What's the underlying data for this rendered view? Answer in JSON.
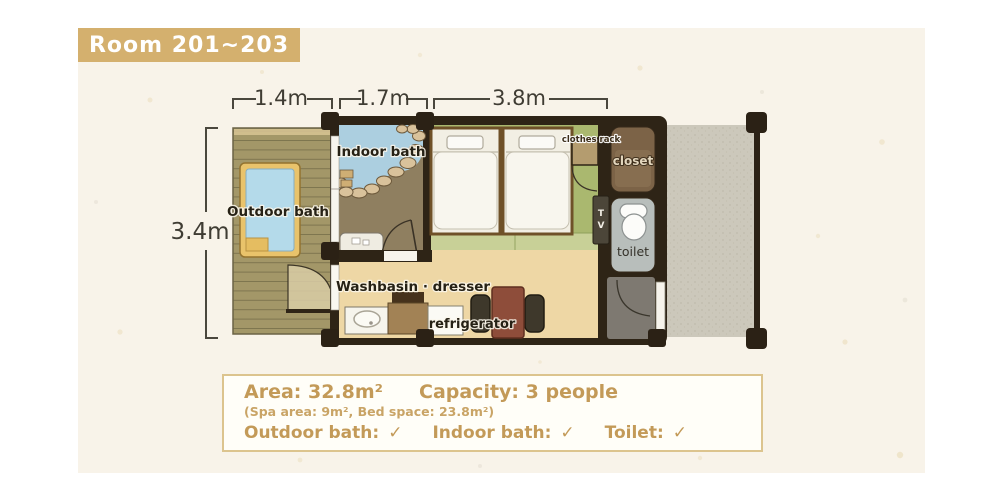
{
  "banner": {
    "title": "Room 201~203",
    "bg_color": "#d4b06e"
  },
  "dimensions": {
    "width_left": "1.4m",
    "width_middle": "1.7m",
    "width_right": "3.8m",
    "height_left": "3.4m"
  },
  "plan": {
    "labels": {
      "outdoor_bath": "Outdoor bath",
      "indoor_bath": "Indoor bath",
      "clothes_rack": "clothes rack",
      "closet": "closet",
      "tv_chars": [
        "T",
        "V"
      ],
      "toilet": "toilet",
      "washbasin_dresser": "Washbasin · dresser",
      "refrigerator": "refrigerator"
    },
    "colors": {
      "wall": "#2e2416",
      "deck": "#a39768",
      "tub_frame": "#e9c36b",
      "tub_water": "#b4daea",
      "bath_water": "#accfe0",
      "bath_floor": "#8f7f60",
      "tatami": "#aab86f",
      "tatami_light": "#c8d097",
      "floor_tan": "#eed7a5",
      "closet": "#7c6347",
      "toilet_room": "#b8bebb",
      "entrance": "#7e7971",
      "terrace": "#ccc8bb",
      "table": "#8e4d3a",
      "accent_gold": "#c39a58",
      "paper": "#f8f3e9"
    }
  },
  "info_box": {
    "area_label": "Area: 32.8m²",
    "capacity_label": "Capacity: 3 people",
    "sub_label": "(Spa area: 9m², Bed space: 23.8m²)",
    "features": [
      {
        "label": "Outdoor bath:",
        "check": "✓"
      },
      {
        "label": "Indoor bath:",
        "check": "✓"
      },
      {
        "label": "Toilet:",
        "check": "✓"
      }
    ]
  }
}
